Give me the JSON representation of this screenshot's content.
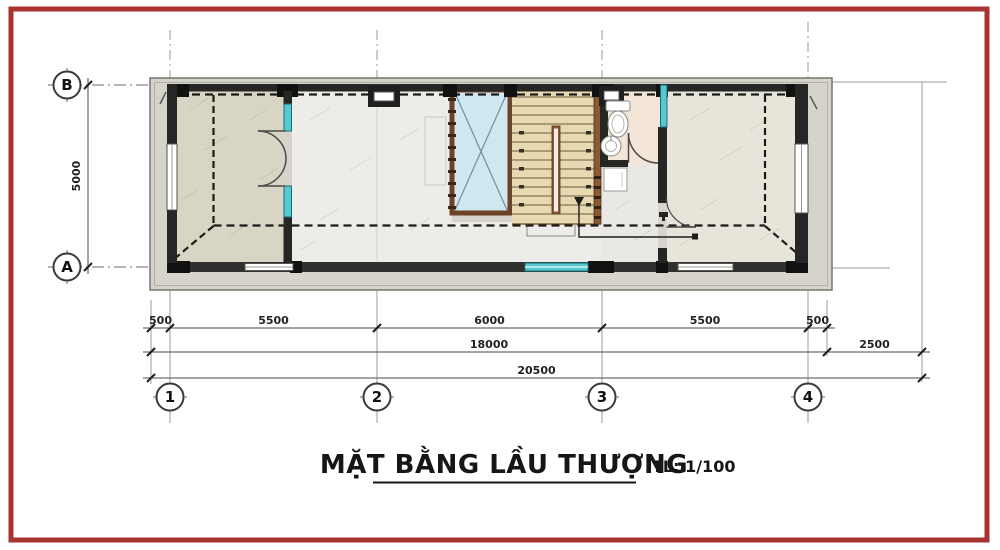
{
  "title": {
    "text": "MẶT BẰNG LẦU THƯỢNG",
    "scale_label": "TL: 1/100"
  },
  "grid": {
    "columns": [
      "1",
      "2",
      "3",
      "4"
    ],
    "rows": [
      "B",
      "A"
    ]
  },
  "dimensions": {
    "top_row": [
      "500",
      "5500",
      "6000",
      "5500",
      "500"
    ],
    "mid_row": [
      "18000",
      "2500"
    ],
    "total_row": [
      "20500"
    ],
    "vertical": [
      "5000"
    ]
  },
  "colors": {
    "frame": "#a93330",
    "wall": "#262624",
    "pier": "#111110",
    "glass_teal": "#56c8d2",
    "skylight_fill": "#cfe7f1",
    "skylight_border": "#6d4327",
    "stair_fill": "#e9d9b2",
    "railing_brown": "#8a5a33",
    "terrace_floor": "#d9d5c4",
    "room_floor": "#edece8",
    "bath_floor": "#f3e6d8",
    "hall_floor": "#eae8e4",
    "right_room_floor": "#e7e4d9",
    "band_gray": "#d5d3ca",
    "dash_line": "#1b1b19"
  }
}
